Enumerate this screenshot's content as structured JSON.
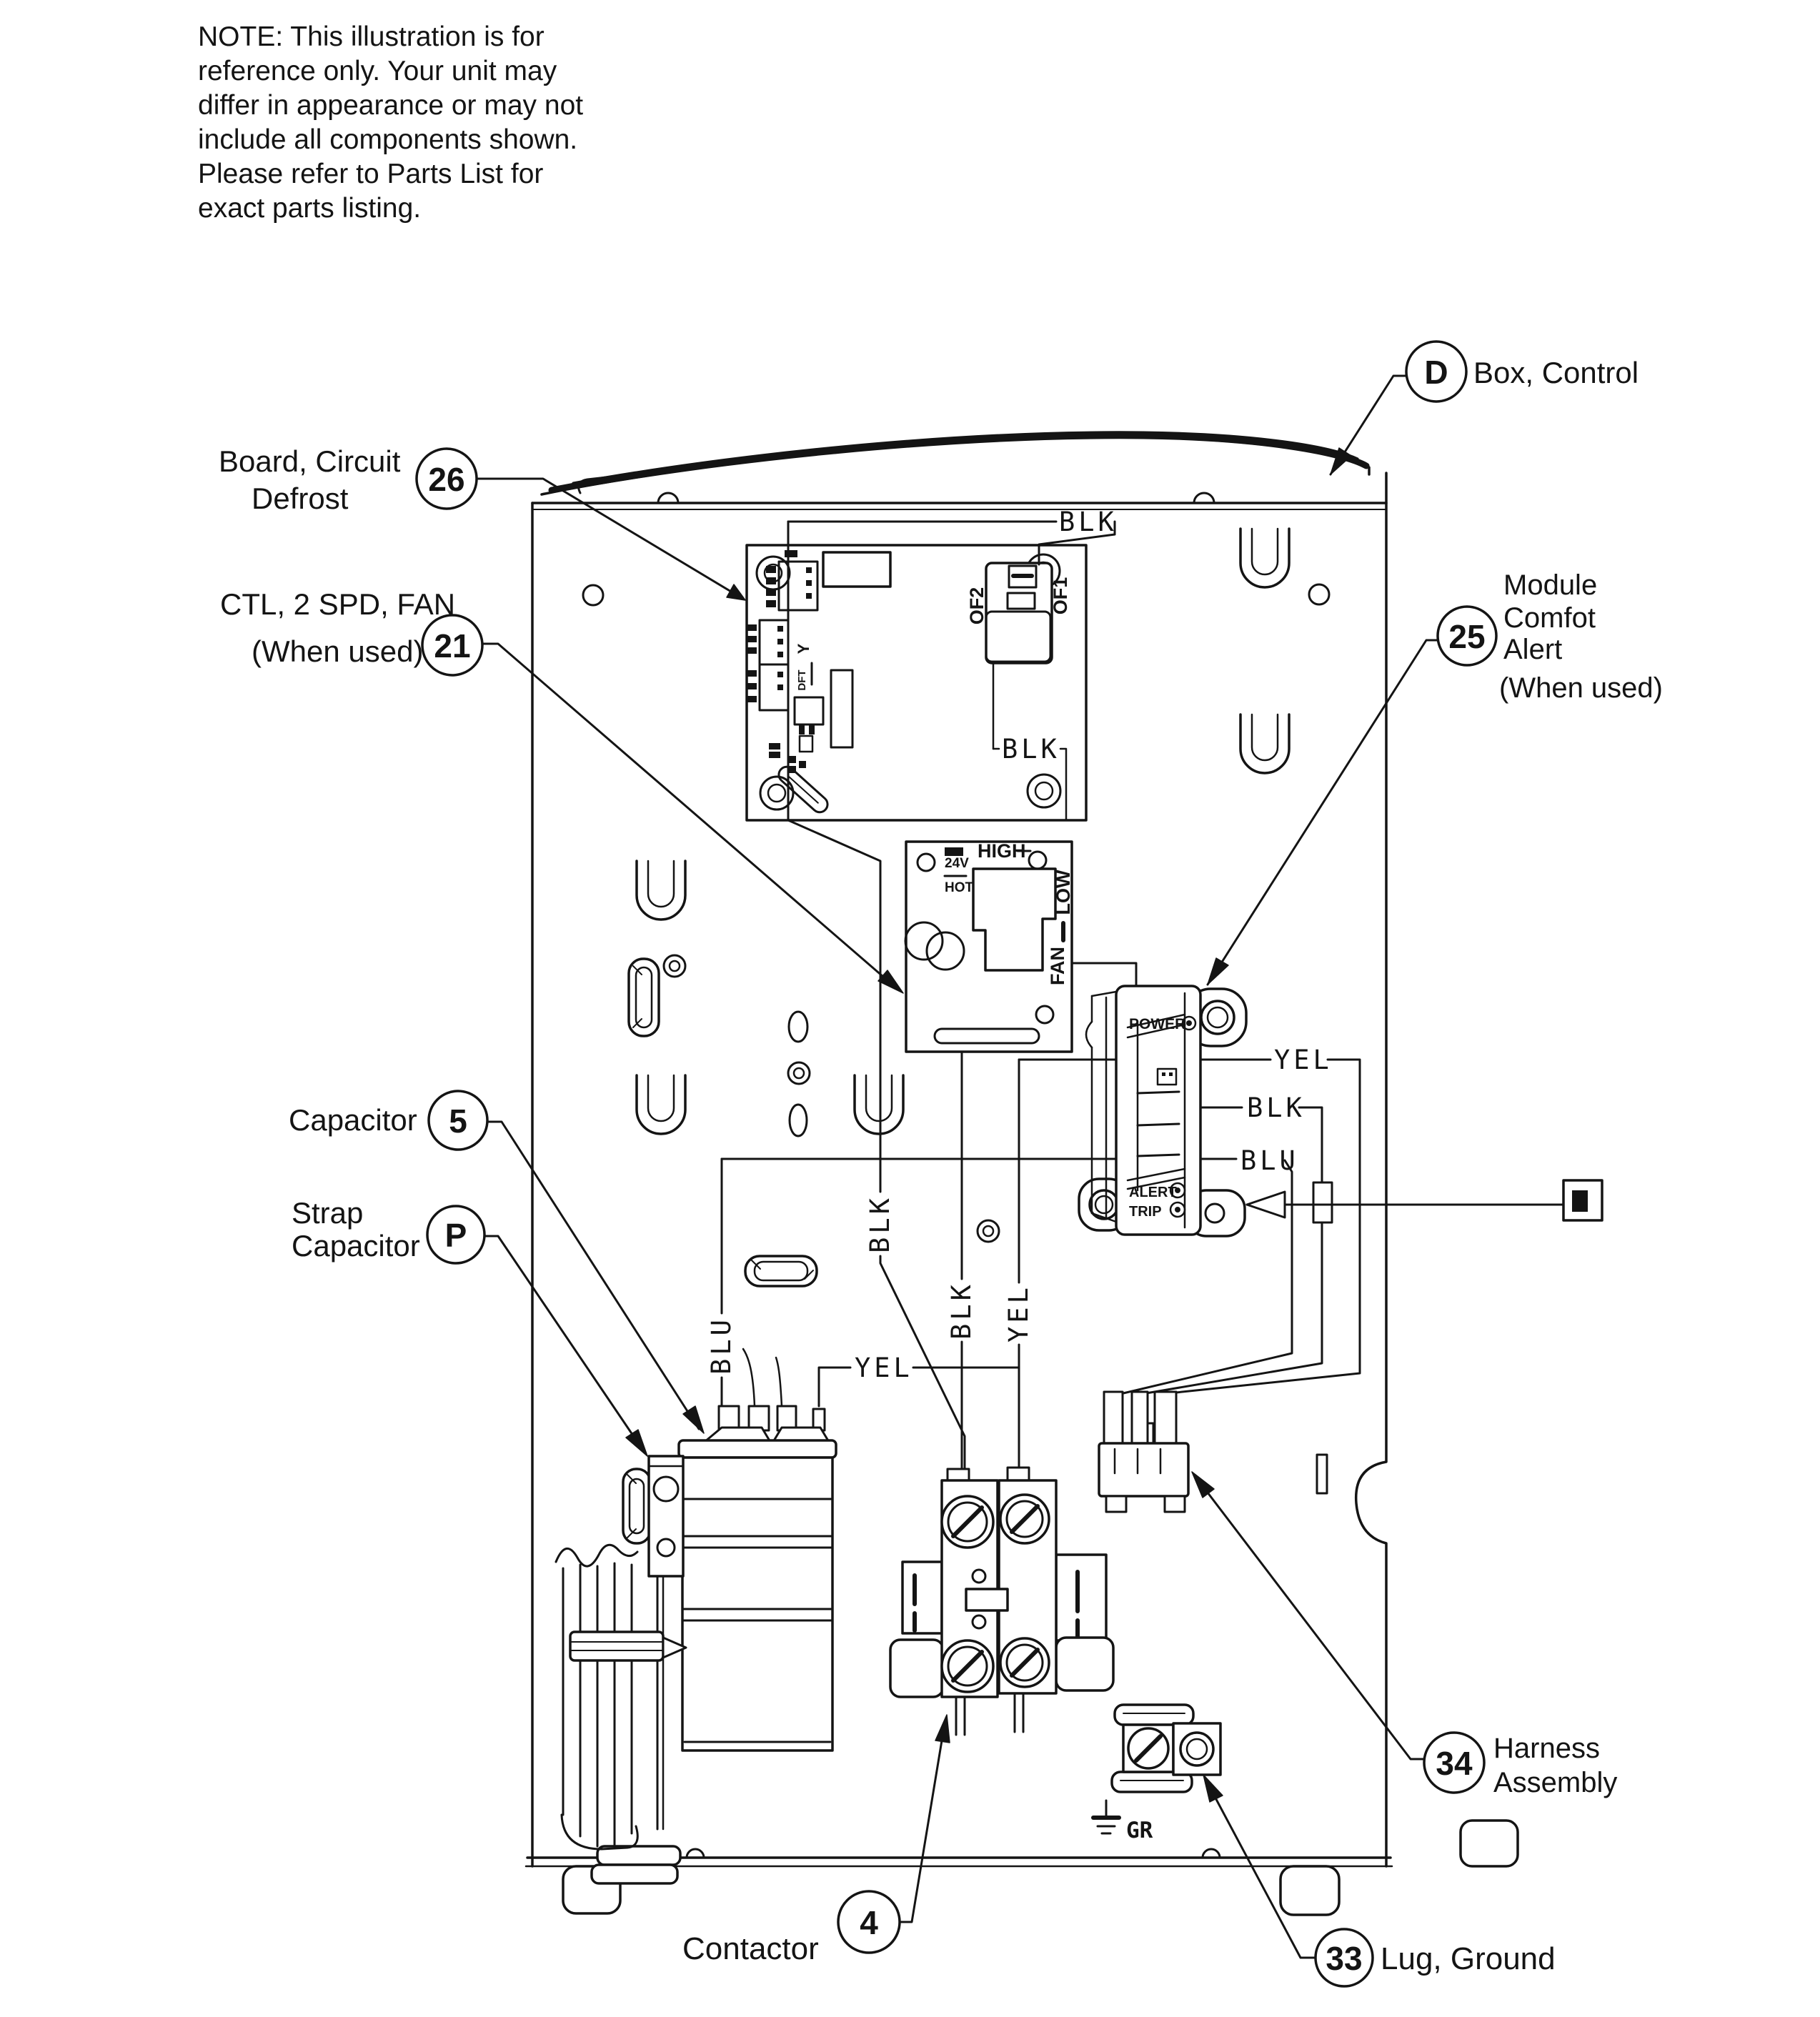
{
  "note": {
    "line1": "NOTE: This illustration is for",
    "line2": "reference only.  Your unit may",
    "line3": "differ in appearance or may not",
    "line4": "include all components shown.",
    "line5": "Please refer to Parts List for",
    "line6": "exact parts listing."
  },
  "callouts": {
    "box_control": {
      "ref": "D",
      "label": "Box, Control"
    },
    "defrost_board": {
      "ref": "26",
      "line1": "Board, Circuit",
      "line2": "Defrost"
    },
    "fan_ctl": {
      "ref": "21",
      "line1": "CTL, 2 SPD, FAN",
      "line2": "(When used)"
    },
    "comfort_alert": {
      "ref": "25",
      "line1": "Module",
      "line2": "Comfot",
      "line3": "Alert",
      "line4": "(When used)"
    },
    "capacitor": {
      "ref": "5",
      "label": "Capacitor"
    },
    "strap": {
      "ref": "P",
      "line1": "Strap",
      "line2": "Capacitor"
    },
    "contactor": {
      "ref": "4",
      "label": "Contactor"
    },
    "lug": {
      "ref": "33",
      "label": "Lug, Ground"
    },
    "harness": {
      "ref": "34",
      "line1": "Harness",
      "line2": "Assembly"
    }
  },
  "wires": {
    "blk": "BLK",
    "yel": "YEL",
    "blu": "BLU",
    "gr": "GR"
  },
  "board26": {
    "of1": "OF1",
    "of2": "OF2"
  },
  "board21": {
    "high": "HIGH",
    "low": "LOW",
    "fan": "FAN",
    "v24": "24V",
    "hot": "HOT",
    "y": "Y",
    "dft": "DFT"
  },
  "module25": {
    "power": "POWER",
    "alert": "ALERT",
    "trip": "TRIP"
  }
}
